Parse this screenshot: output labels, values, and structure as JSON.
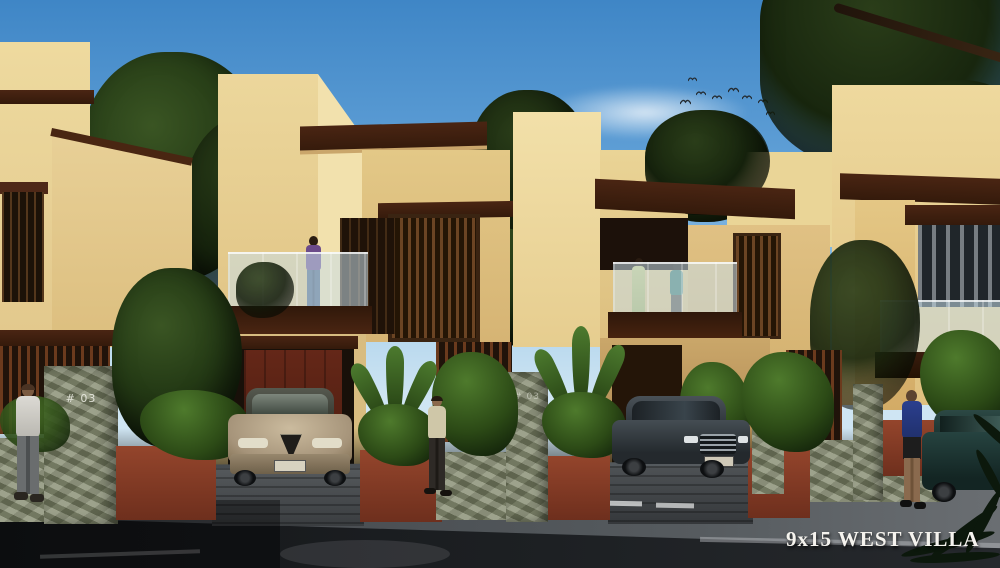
{
  "scene": {
    "type": "architectural-exterior-render",
    "description": "Row of modern two-storey cream villas with brown canopies, balconies, garden walls, cars and pedestrians at dusk",
    "watermark": "9x15 WEST VILLA",
    "villas_visible": 4,
    "people_on_street": 3,
    "people_on_balconies": 3,
    "cars_visible": 3,
    "birds_in_sky": 9
  },
  "labels": {
    "gate_pillar_left": "# 03",
    "gate_pillar_center": "# 03"
  },
  "palette": {
    "sky_top": "#3f86c6",
    "sky_horizon": "#cfe5f3",
    "wall_light": "#f0dda4",
    "wall_mid": "#e6cf96",
    "wall_shade": "#d8ba7a",
    "roof_brown": "#44220f",
    "garage_maroon": "#5c2315",
    "terracotta_wall": "#8a3d27",
    "stone_pillar": "#8d9379",
    "foliage_dark": "#18260e",
    "foliage_mid": "#35511f",
    "road_asphalt": "#1a1d20",
    "sidewalk": "#4a4e52",
    "watermark_color": "#f5f3ee"
  }
}
